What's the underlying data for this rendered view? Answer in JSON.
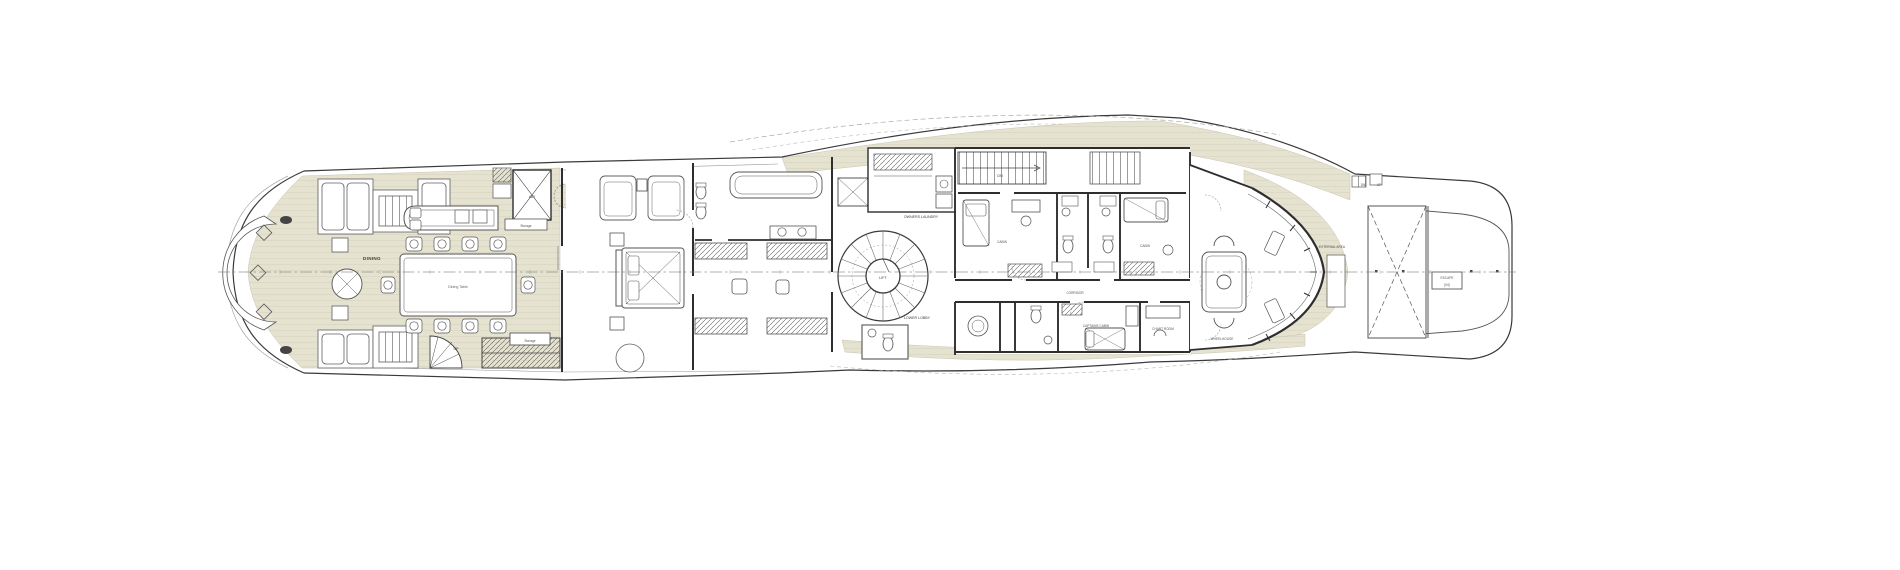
{
  "diagram": {
    "colors": {
      "background": "#ffffff",
      "deck_teak": "#e6e2d0",
      "deck_plank_line": "#d8d4c1",
      "ink": "#3a3a3a",
      "wall": "#2e2e2e",
      "furniture_line": "#606060",
      "faint_line": "#a8a8a8",
      "label_text": "#3c3c3c"
    },
    "labels": {
      "dining": "DINING",
      "dining_table": "Dining Table",
      "air": "AIR",
      "storage_mid": "Storage",
      "storage_aft": "Storage",
      "up_aft": "UP",
      "dn_fwd": "DN",
      "owners_laundry": "OWNERS LAUNDRY",
      "lift": "LIFT",
      "lower_lobby": "LOWER LOBBY",
      "corridor": "CORRIDOR",
      "cabin_port": "CABIN",
      "cabin_stbd": "CABIN",
      "captains_cabin": "CAPTAINS CABIN",
      "chart_room": "CHART ROOM",
      "wheelhouse": "WHEELHOUSE",
      "external_area": "EXTERNAL AREA",
      "escape_line1": "ESCAPE",
      "escape_line2": "[04]",
      "dn_bow": "DN",
      "up_bow": "UP"
    }
  }
}
